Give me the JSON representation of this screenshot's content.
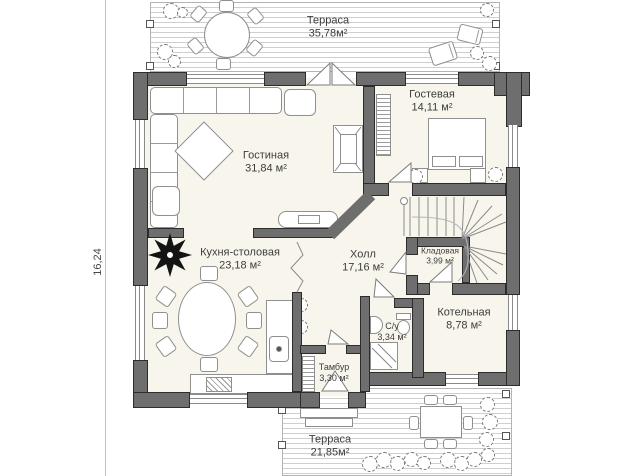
{
  "plan": {
    "title": "first-floor-plan",
    "dimension_left": "16,24",
    "terraces": {
      "top": {
        "name": "Терраса",
        "area": "35,78м²"
      },
      "bottom": {
        "name": "Терраса",
        "area": "21,85м²"
      }
    },
    "rooms": {
      "living": {
        "name": "Гостиная",
        "area": "31,84 м²"
      },
      "guest": {
        "name": "Гостевая",
        "area": "14,11 м²"
      },
      "kitchen": {
        "name": "Кухня-столовая",
        "area": "23,18 м²"
      },
      "hall": {
        "name": "Холл",
        "area": "17,16 м²"
      },
      "storage": {
        "name": "Кладовая",
        "area": "3,99 м²"
      },
      "boiler": {
        "name": "Котельная",
        "area": "8,78 м²"
      },
      "wc": {
        "name": "С/у",
        "area": "3,34 м²"
      },
      "tambour": {
        "name": "Тамбур",
        "area": "3,30 м²"
      }
    },
    "colors": {
      "wall": "#6e6e6e",
      "floor": "#f8f6ec",
      "text": "#3c3c3c"
    }
  }
}
